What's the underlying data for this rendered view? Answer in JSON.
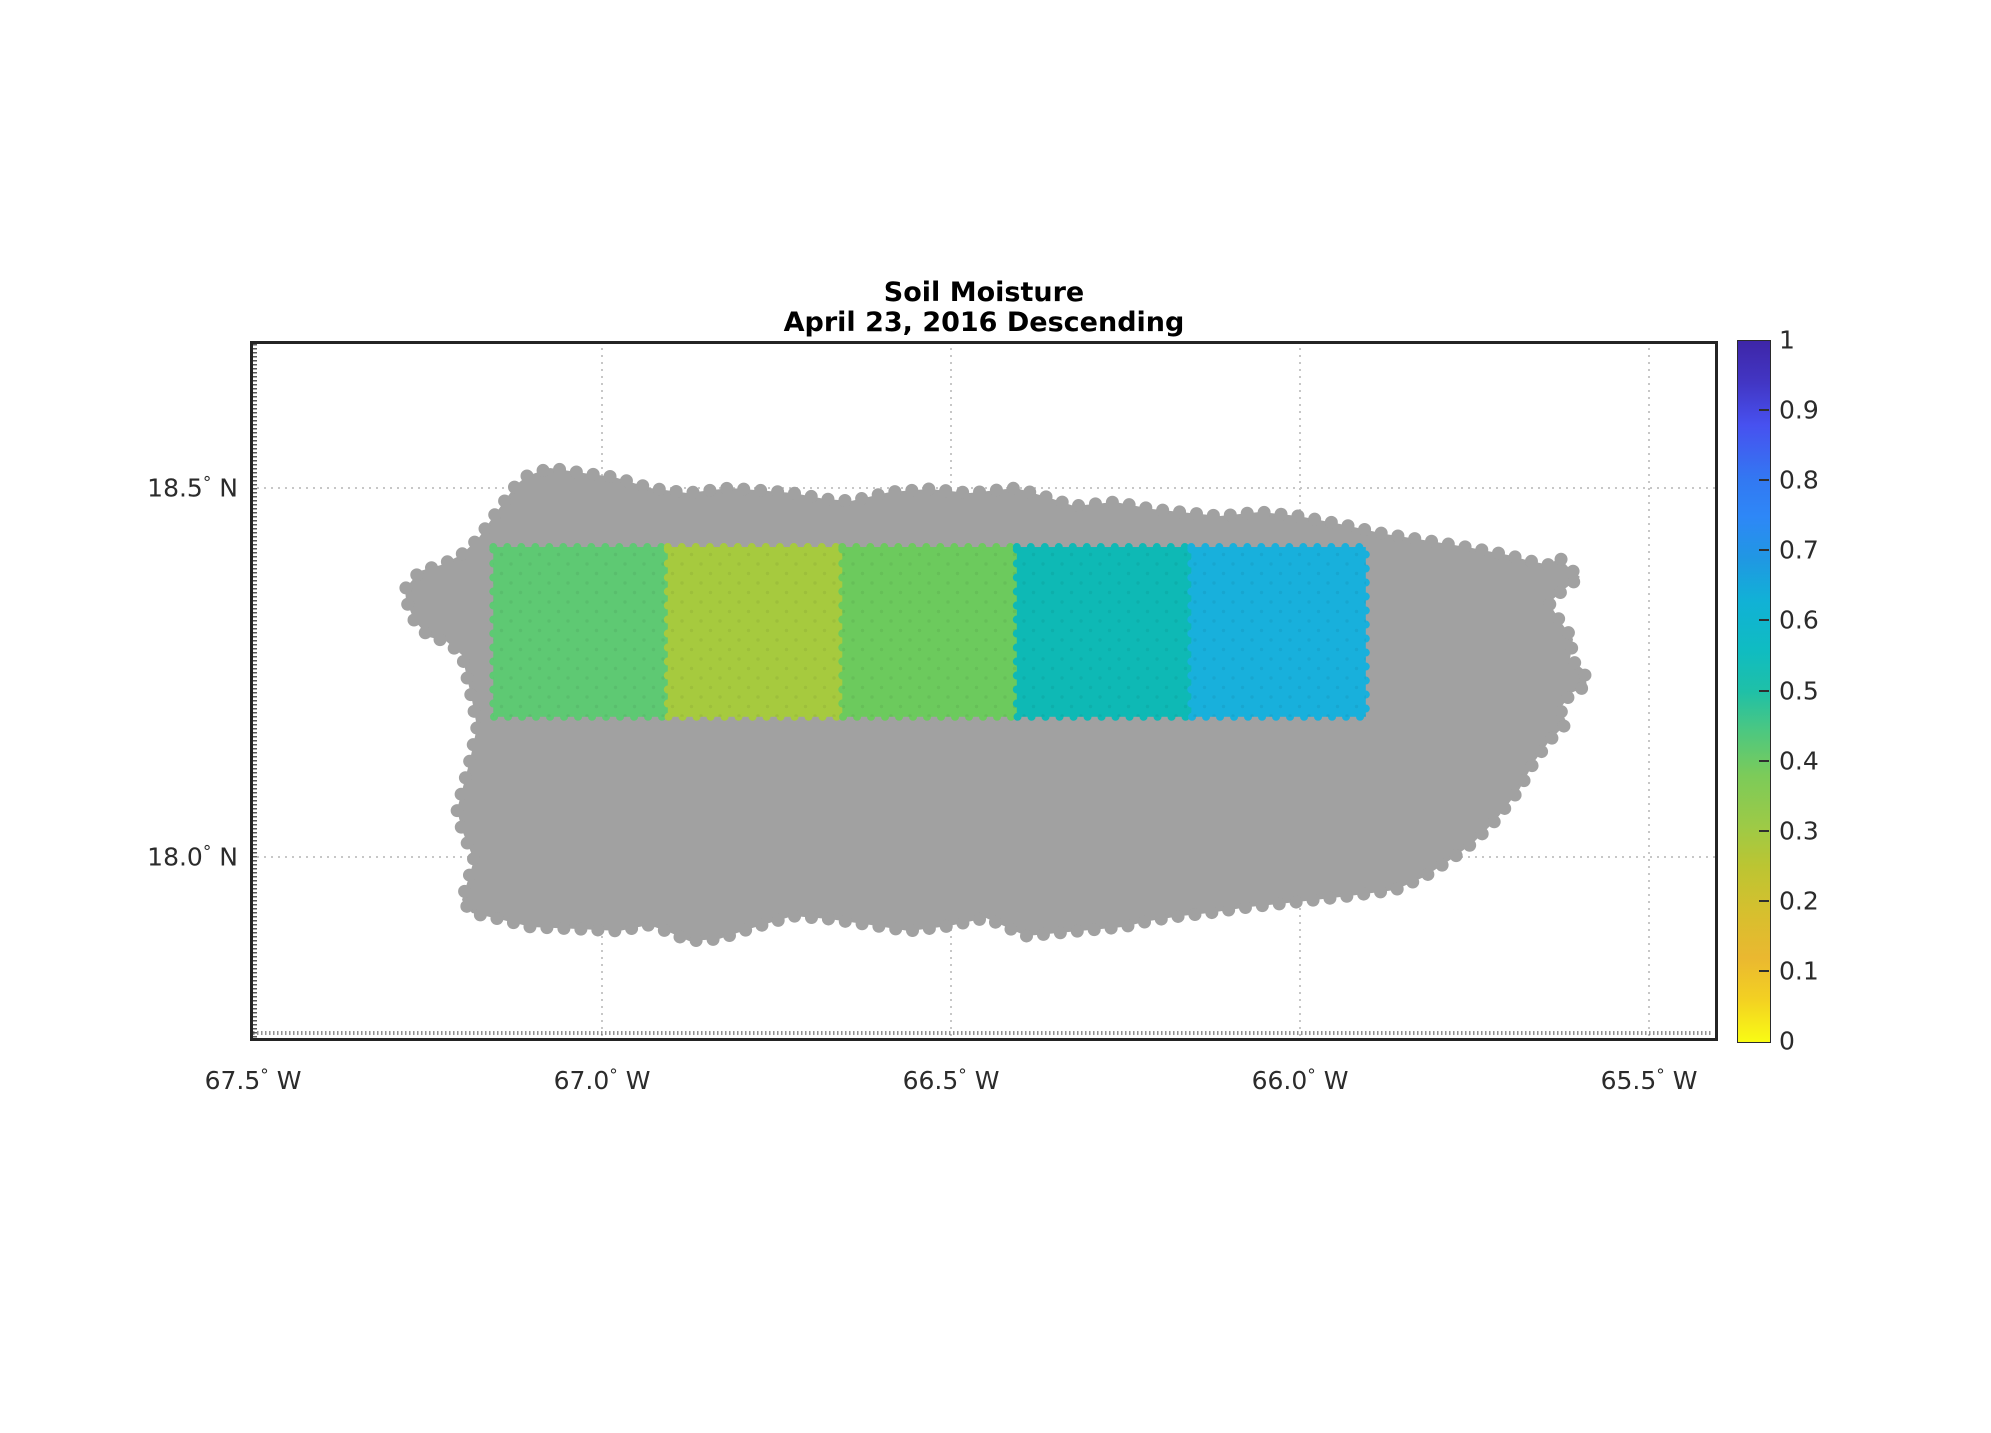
{
  "title": {
    "line1": "Soil Moisture",
    "line2": "April 23, 2016 Descending"
  },
  "x_axis": {
    "ticks": [
      {
        "label": "67.5° W",
        "lon_w": 67.5
      },
      {
        "label": "67.0° W",
        "lon_w": 67.0
      },
      {
        "label": "66.5° W",
        "lon_w": 66.5
      },
      {
        "label": "66.0° W",
        "lon_w": 66.0
      },
      {
        "label": "65.5° W",
        "lon_w": 65.5
      }
    ]
  },
  "y_axis": {
    "ticks": [
      {
        "label": "18.5° N",
        "lat_n": 18.5
      },
      {
        "label": "18.0° N",
        "lat_n": 18.0
      }
    ]
  },
  "grid": {
    "style": "dotted",
    "color": "#c7c7c7"
  },
  "map": {
    "land_color": "#a1a1a1",
    "land_name": "island landmass"
  },
  "colorbar": {
    "min": 0,
    "max": 1,
    "labels": [
      "1",
      "0.9",
      "0.8",
      "0.7",
      "0.6",
      "0.5",
      "0.4",
      "0.3",
      "0.2",
      "0.1",
      "0"
    ],
    "colormap_name": "parula-reversed",
    "gradient": [
      {
        "v": 1.0,
        "color": "#3e26a8"
      },
      {
        "v": 0.94,
        "color": "#4236c4"
      },
      {
        "v": 0.88,
        "color": "#4751f0"
      },
      {
        "v": 0.8,
        "color": "#3279f2"
      },
      {
        "v": 0.75,
        "color": "#2e87f7"
      },
      {
        "v": 0.69,
        "color": "#2097e3"
      },
      {
        "v": 0.63,
        "color": "#11b1d6"
      },
      {
        "v": 0.56,
        "color": "#0fbcc2"
      },
      {
        "v": 0.5,
        "color": "#1fc0a7"
      },
      {
        "v": 0.44,
        "color": "#4fc87e"
      },
      {
        "v": 0.38,
        "color": "#7ccb59"
      },
      {
        "v": 0.31,
        "color": "#9cca47"
      },
      {
        "v": 0.25,
        "color": "#bcc532"
      },
      {
        "v": 0.18,
        "color": "#d8bf2e"
      },
      {
        "v": 0.12,
        "color": "#eab830"
      },
      {
        "v": 0.06,
        "color": "#f3d122"
      },
      {
        "v": 0.0,
        "color": "#f9fb14"
      }
    ]
  },
  "chart_data": {
    "type": "heatmap",
    "title": "Soil Moisture — April 23, 2016 Descending",
    "xlabel": "Longitude (degrees West)",
    "ylabel": "Latitude (degrees North)",
    "xlim_lon_w": [
      67.5,
      65.4
    ],
    "ylim_lat_n": [
      17.75,
      18.7
    ],
    "colorbar_range": [
      0,
      1
    ],
    "grid_on": true,
    "legend_position": "right-colorbar",
    "cells": [
      {
        "lon_w_range": [
          67.15,
          66.9
        ],
        "lat_n_range": [
          18.19,
          18.42
        ],
        "value": 0.43,
        "color": "#5ec973"
      },
      {
        "lon_w_range": [
          66.9,
          66.65
        ],
        "lat_n_range": [
          18.19,
          18.42
        ],
        "value": 0.28,
        "color": "#a6ca3e"
      },
      {
        "lon_w_range": [
          66.65,
          66.4
        ],
        "lat_n_range": [
          18.19,
          18.42
        ],
        "value": 0.4,
        "color": "#6cca5d"
      },
      {
        "lon_w_range": [
          66.4,
          66.15
        ],
        "lat_n_range": [
          18.19,
          18.42
        ],
        "value": 0.54,
        "color": "#0eb9b5"
      },
      {
        "lon_w_range": [
          66.15,
          65.9
        ],
        "lat_n_range": [
          18.19,
          18.42
        ],
        "value": 0.62,
        "color": "#18b0dc"
      }
    ]
  }
}
